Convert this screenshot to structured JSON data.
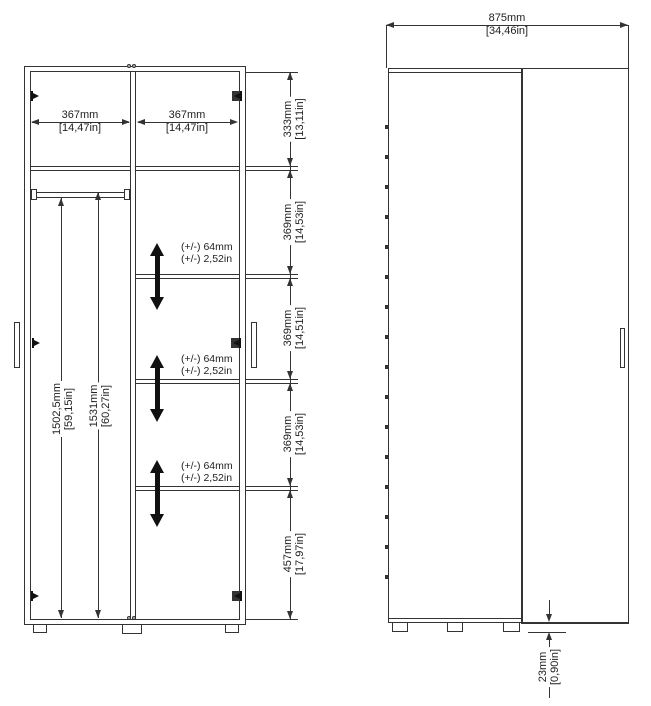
{
  "left_view": {
    "width_left": {
      "mm": "367mm",
      "inch": "[14,47in]"
    },
    "width_right": {
      "mm": "367mm",
      "inch": "[14,47in]"
    },
    "rail_height": {
      "mm": "1502,5mm",
      "inch": "[59,15in]"
    },
    "interior_height": {
      "mm": "1531mm",
      "inch": "[60,27in]"
    },
    "right_chain": [
      {
        "mm": "333mm",
        "inch": "[13,11in]"
      },
      {
        "mm": "369mm",
        "inch": "[14,53in]"
      },
      {
        "mm": "369mm",
        "inch": "[14,51in]"
      },
      {
        "mm": "369mm",
        "inch": "[14,53in]"
      },
      {
        "mm": "457mm",
        "inch": "[17,97in]"
      }
    ],
    "shelf_adjust": [
      {
        "mm": "(+/-) 64mm",
        "inch": "(+/-) 2,52in"
      },
      {
        "mm": "(+/-) 64mm",
        "inch": "(+/-) 2,52in"
      },
      {
        "mm": "(+/-) 64mm",
        "inch": "(+/-) 2,52in"
      }
    ]
  },
  "front_view": {
    "width": {
      "mm": "875mm",
      "inch": "[34,46in]"
    },
    "floor_gap": {
      "mm": "23mm",
      "inch": "[0,90in]"
    }
  },
  "colors": {
    "line": "#333333",
    "arrow_fill": "#111111",
    "background": "#ffffff"
  }
}
